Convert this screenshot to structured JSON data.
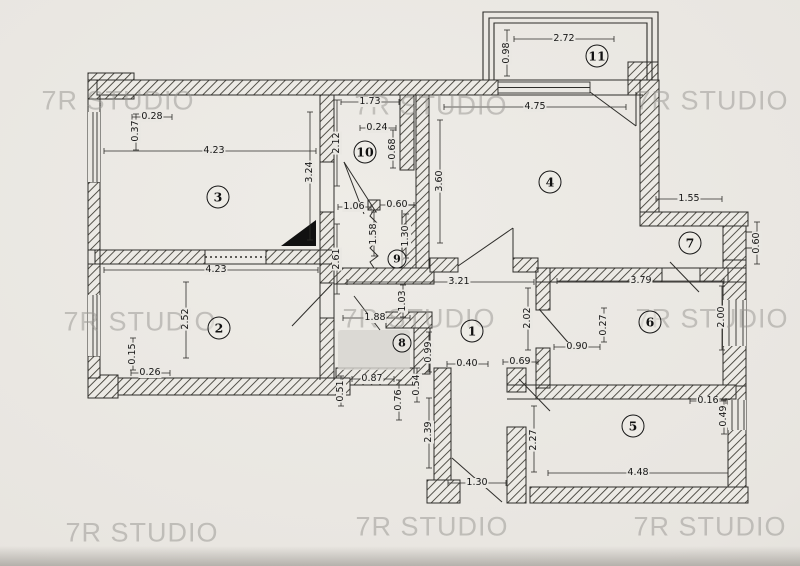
{
  "document": {
    "type": "apartment-floor-plan-scan"
  },
  "colors": {
    "paper": "#e8e5e0",
    "ink": "#2e2d2a",
    "hatch_fill": "#eceae5",
    "watermark": "#979591",
    "smudge": "#d7d4cf"
  },
  "watermark": {
    "text": "7R STUDIO",
    "items": [
      {
        "text": "7R STUDIO",
        "x": 118,
        "y": 101
      },
      {
        "text": "7R STUDIO",
        "x": 431,
        "y": 106
      },
      {
        "text": "7R STUDIO",
        "x": 712,
        "y": 101
      },
      {
        "text": "7R STUDIO",
        "x": 140,
        "y": 322
      },
      {
        "text": "7R STUDIO",
        "x": 419,
        "y": 319
      },
      {
        "text": "7R STUDIO",
        "x": 712,
        "y": 319
      },
      {
        "text": "7R STUDIO",
        "x": 142,
        "y": 533
      },
      {
        "text": "7R STUDIO",
        "x": 432,
        "y": 527
      },
      {
        "text": "7R STUDIO",
        "x": 710,
        "y": 527
      }
    ]
  },
  "rooms": [
    {
      "label": "1",
      "x": 472,
      "y": 331
    },
    {
      "label": "2",
      "x": 219,
      "y": 328
    },
    {
      "label": "3",
      "x": 218,
      "y": 197
    },
    {
      "label": "4",
      "x": 550,
      "y": 182
    },
    {
      "label": "5",
      "x": 633,
      "y": 426
    },
    {
      "label": "6",
      "x": 650,
      "y": 322
    },
    {
      "label": "7",
      "x": 690,
      "y": 243
    },
    {
      "label": "8",
      "x": 402,
      "y": 343,
      "small": true
    },
    {
      "label": "9",
      "x": 397,
      "y": 259,
      "small": true
    },
    {
      "label": "10",
      "x": 365,
      "y": 152
    },
    {
      "label": "11",
      "x": 597,
      "y": 56
    }
  ],
  "dimensions": [
    {
      "t": "0.28",
      "x": 152,
      "y": 117,
      "l": [
        132,
        117,
        172,
        117
      ]
    },
    {
      "t": "0.37",
      "x": 136,
      "y": 131,
      "v": true,
      "l": [
        136,
        114,
        136,
        150
      ]
    },
    {
      "t": "4.23",
      "x": 214,
      "y": 151,
      "l": [
        104,
        151,
        316,
        151
      ]
    },
    {
      "t": "3.24",
      "x": 310,
      "y": 172,
      "v": true,
      "l": [
        310,
        112,
        310,
        240
      ]
    },
    {
      "t": "2.12",
      "x": 337,
      "y": 143,
      "v": true,
      "l": [
        337,
        100,
        337,
        186
      ]
    },
    {
      "t": "1.73",
      "x": 370,
      "y": 102,
      "l": [
        341,
        102,
        399,
        102
      ]
    },
    {
      "t": "0.24",
      "x": 377,
      "y": 128,
      "l": [
        360,
        128,
        396,
        128
      ]
    },
    {
      "t": "0.68",
      "x": 393,
      "y": 149,
      "v": true,
      "l": [
        393,
        130,
        393,
        168
      ]
    },
    {
      "t": "0.98",
      "x": 507,
      "y": 53,
      "v": true,
      "l": [
        507,
        30,
        507,
        76
      ]
    },
    {
      "t": "2.72",
      "x": 564,
      "y": 39,
      "l": [
        514,
        39,
        614,
        39
      ]
    },
    {
      "t": "4.75",
      "x": 535,
      "y": 107,
      "l": [
        444,
        107,
        626,
        107
      ]
    },
    {
      "t": "3.60",
      "x": 440,
      "y": 181,
      "v": true,
      "l": [
        440,
        120,
        440,
        243
      ]
    },
    {
      "t": "1.55",
      "x": 689,
      "y": 199,
      "l": [
        656,
        199,
        722,
        199
      ]
    },
    {
      "t": "0.60",
      "x": 757,
      "y": 243,
      "v": true,
      "l": [
        757,
        222,
        757,
        264
      ]
    },
    {
      "t": "1.06",
      "x": 354,
      "y": 207,
      "l": [
        338,
        207,
        371,
        207
      ]
    },
    {
      "t": "0.60",
      "x": 397,
      "y": 205,
      "l": [
        380,
        205,
        414,
        205
      ]
    },
    {
      "t": "1.58",
      "x": 374,
      "y": 234,
      "v": true,
      "l": [
        374,
        212,
        374,
        256
      ]
    },
    {
      "t": "1.30",
      "x": 406,
      "y": 236,
      "v": true,
      "l": [
        406,
        214,
        406,
        258
      ]
    },
    {
      "t": "2.61",
      "x": 337,
      "y": 259,
      "v": true,
      "l": [
        337,
        224,
        337,
        294
      ]
    },
    {
      "t": "3.21",
      "x": 459,
      "y": 282,
      "l": [
        347,
        282,
        534,
        282
      ]
    },
    {
      "t": "3.79",
      "x": 641,
      "y": 281,
      "l": [
        557,
        281,
        724,
        281
      ]
    },
    {
      "t": "4.23",
      "x": 216,
      "y": 270,
      "l": [
        104,
        270,
        318,
        270
      ]
    },
    {
      "t": "2.52",
      "x": 186,
      "y": 319,
      "v": true,
      "l": [
        186,
        282,
        186,
        358
      ]
    },
    {
      "t": "0.15",
      "x": 133,
      "y": 354,
      "v": true,
      "l": [
        133,
        338,
        133,
        370
      ]
    },
    {
      "t": "0.26",
      "x": 150,
      "y": 373,
      "l": [
        131,
        373,
        170,
        373
      ]
    },
    {
      "t": "2.02",
      "x": 528,
      "y": 318,
      "v": true,
      "l": [
        528,
        288,
        528,
        350
      ]
    },
    {
      "t": "0.27",
      "x": 604,
      "y": 325,
      "v": true,
      "l": [
        604,
        308,
        604,
        342
      ]
    },
    {
      "t": "2.00",
      "x": 722,
      "y": 317,
      "v": true,
      "l": [
        722,
        286,
        722,
        350
      ]
    },
    {
      "t": "0.90",
      "x": 577,
      "y": 347,
      "l": [
        554,
        347,
        600,
        347
      ]
    },
    {
      "t": "1.88",
      "x": 375,
      "y": 318,
      "l": [
        343,
        318,
        410,
        318
      ]
    },
    {
      "t": "1.03",
      "x": 403,
      "y": 301,
      "v": true,
      "l": [
        403,
        285,
        403,
        317
      ]
    },
    {
      "t": "0.99",
      "x": 429,
      "y": 352,
      "v": true,
      "l": [
        429,
        332,
        429,
        372
      ]
    },
    {
      "t": "0.40",
      "x": 467,
      "y": 364,
      "l": [
        447,
        364,
        488,
        364
      ]
    },
    {
      "t": "0.69",
      "x": 520,
      "y": 362,
      "l": [
        503,
        362,
        538,
        362
      ]
    },
    {
      "t": "0.87",
      "x": 372,
      "y": 379,
      "l": [
        352,
        379,
        394,
        379
      ]
    },
    {
      "t": "0.51",
      "x": 341,
      "y": 391,
      "v": true,
      "l": [
        341,
        376,
        341,
        406
      ]
    },
    {
      "t": "0.54",
      "x": 417,
      "y": 385,
      "v": true,
      "l": [
        417,
        368,
        417,
        402
      ]
    },
    {
      "t": "0.76",
      "x": 399,
      "y": 400,
      "v": true,
      "l": [
        399,
        380,
        399,
        420
      ]
    },
    {
      "t": "2.39",
      "x": 429,
      "y": 432,
      "v": true,
      "l": [
        429,
        398,
        429,
        468
      ]
    },
    {
      "t": "1.30",
      "x": 477,
      "y": 483,
      "l": [
        448,
        483,
        506,
        483
      ]
    },
    {
      "t": "2.27",
      "x": 534,
      "y": 440,
      "v": true,
      "l": [
        534,
        406,
        534,
        472
      ]
    },
    {
      "t": "4.48",
      "x": 638,
      "y": 473,
      "l": [
        548,
        473,
        728,
        473
      ]
    },
    {
      "t": "0.16",
      "x": 708,
      "y": 401,
      "l": [
        690,
        401,
        726,
        401
      ]
    },
    {
      "t": "0.49",
      "x": 724,
      "y": 416,
      "v": true,
      "l": [
        724,
        400,
        724,
        434
      ]
    }
  ]
}
